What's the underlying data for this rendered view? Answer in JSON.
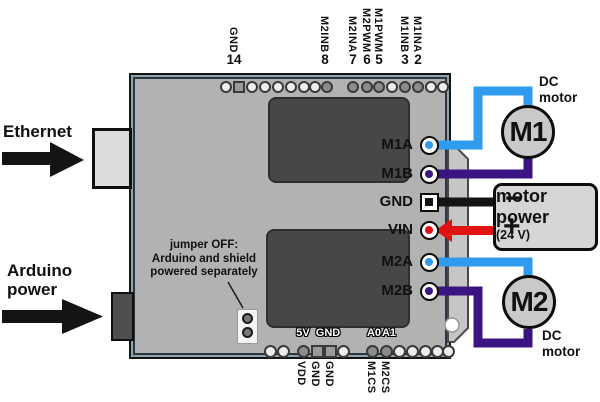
{
  "colors": {
    "wire_m_a": "#2f9bee",
    "wire_m_b": "#3a1482",
    "wire_gnd": "#141414",
    "wire_vin": "#e01212",
    "arrow_black": "#141414",
    "board": "#b2b2b2",
    "chip": "#474747"
  },
  "left_annotations": {
    "ethernet_label": "Ethernet",
    "arduino_power_line1": "Arduino",
    "arduino_power_line2": "power"
  },
  "jumper_note": {
    "line1": "jumper OFF:",
    "line2": "Arduino and shield",
    "line3": "powered separately"
  },
  "top_header": {
    "pin_labels": [
      {
        "name": "GND",
        "number": "14",
        "x": 234
      },
      {
        "name": "M2INB",
        "number": "8",
        "x": 325
      },
      {
        "name": "M2INA",
        "number": "7",
        "x": 353
      },
      {
        "name": "M2PWM",
        "number": "6",
        "x": 367
      },
      {
        "name": "M1PWM",
        "number": "5",
        "x": 379
      },
      {
        "name": "M1INB",
        "number": "3",
        "x": 405
      },
      {
        "name": "M1INA",
        "number": "2",
        "x": 418
      }
    ],
    "pins": [
      {
        "x": 226,
        "shape": "circle",
        "shade": "light"
      },
      {
        "x": 239,
        "shape": "square",
        "shade": "mid"
      },
      {
        "x": 252,
        "shape": "circle",
        "shade": "light"
      },
      {
        "x": 265,
        "shape": "circle",
        "shade": "light"
      },
      {
        "x": 278,
        "shape": "circle",
        "shade": "light"
      },
      {
        "x": 291,
        "shape": "circle",
        "shade": "light"
      },
      {
        "x": 304,
        "shape": "circle",
        "shade": "light"
      },
      {
        "x": 315,
        "shape": "circle",
        "shade": "light"
      },
      {
        "x": 327,
        "shape": "circle",
        "shade": "dark"
      },
      {
        "x": 353,
        "shape": "circle",
        "shade": "dark"
      },
      {
        "x": 367,
        "shape": "circle",
        "shade": "dark"
      },
      {
        "x": 379,
        "shape": "circle",
        "shade": "dark"
      },
      {
        "x": 392,
        "shape": "circle",
        "shade": "light"
      },
      {
        "x": 405,
        "shape": "circle",
        "shade": "dark"
      },
      {
        "x": 418,
        "shape": "circle",
        "shade": "dark"
      },
      {
        "x": 431,
        "shape": "circle",
        "shade": "light"
      },
      {
        "x": 443,
        "shape": "circle",
        "shade": "light"
      }
    ]
  },
  "bottom_header": {
    "silkscreen": [
      {
        "text": "5V",
        "x": 303
      },
      {
        "text": "GND",
        "x": 328
      },
      {
        "text": "A0",
        "x": 374
      },
      {
        "text": "A1",
        "x": 389
      }
    ],
    "pin_labels": [
      {
        "name": "VDD",
        "x": 302
      },
      {
        "name": "GND",
        "x": 316
      },
      {
        "name": "GND",
        "x": 330
      },
      {
        "name": "M1CS",
        "x": 372
      },
      {
        "name": "M2CS",
        "x": 386
      }
    ],
    "pins": [
      {
        "x": 270,
        "shape": "circle",
        "shade": "light"
      },
      {
        "x": 283,
        "shape": "circle",
        "shade": "light"
      },
      {
        "x": 303,
        "shape": "circle",
        "shade": "dark"
      },
      {
        "x": 317,
        "shape": "square",
        "shade": "mid"
      },
      {
        "x": 330,
        "shape": "square",
        "shade": "mid"
      },
      {
        "x": 343,
        "shape": "circle",
        "shade": "light"
      },
      {
        "x": 372,
        "shape": "circle",
        "shade": "dark"
      },
      {
        "x": 386,
        "shape": "circle",
        "shade": "dark"
      },
      {
        "x": 399,
        "shape": "circle",
        "shade": "light"
      },
      {
        "x": 412,
        "shape": "circle",
        "shade": "light"
      },
      {
        "x": 425,
        "shape": "circle",
        "shade": "light"
      },
      {
        "x": 437,
        "shape": "circle",
        "shade": "light"
      },
      {
        "x": 448,
        "shape": "circle",
        "shade": "light"
      }
    ]
  },
  "right_header": {
    "pins": [
      {
        "label": "M1A",
        "y": 145,
        "shape": "circle",
        "wire": "m_a"
      },
      {
        "label": "M1B",
        "y": 174,
        "shape": "circle",
        "wire": "m_b"
      },
      {
        "label": "GND",
        "y": 202,
        "shape": "square",
        "wire": "gnd"
      },
      {
        "label": "VIN",
        "y": 230,
        "shape": "circle",
        "wire": "vin"
      },
      {
        "label": "M2A",
        "y": 262,
        "shape": "circle",
        "wire": "m_a"
      },
      {
        "label": "M2B",
        "y": 291,
        "shape": "circle",
        "wire": "m_b"
      }
    ]
  },
  "motors": {
    "m1": {
      "label": "M1",
      "caption_line1": "DC",
      "caption_line2": "motor"
    },
    "m2": {
      "label": "M2",
      "caption_line1": "DC",
      "caption_line2": "motor"
    }
  },
  "power_supply": {
    "minus": "−",
    "plus": "+",
    "line1": "motor",
    "line2": "power",
    "line3": "(24 V)"
  }
}
